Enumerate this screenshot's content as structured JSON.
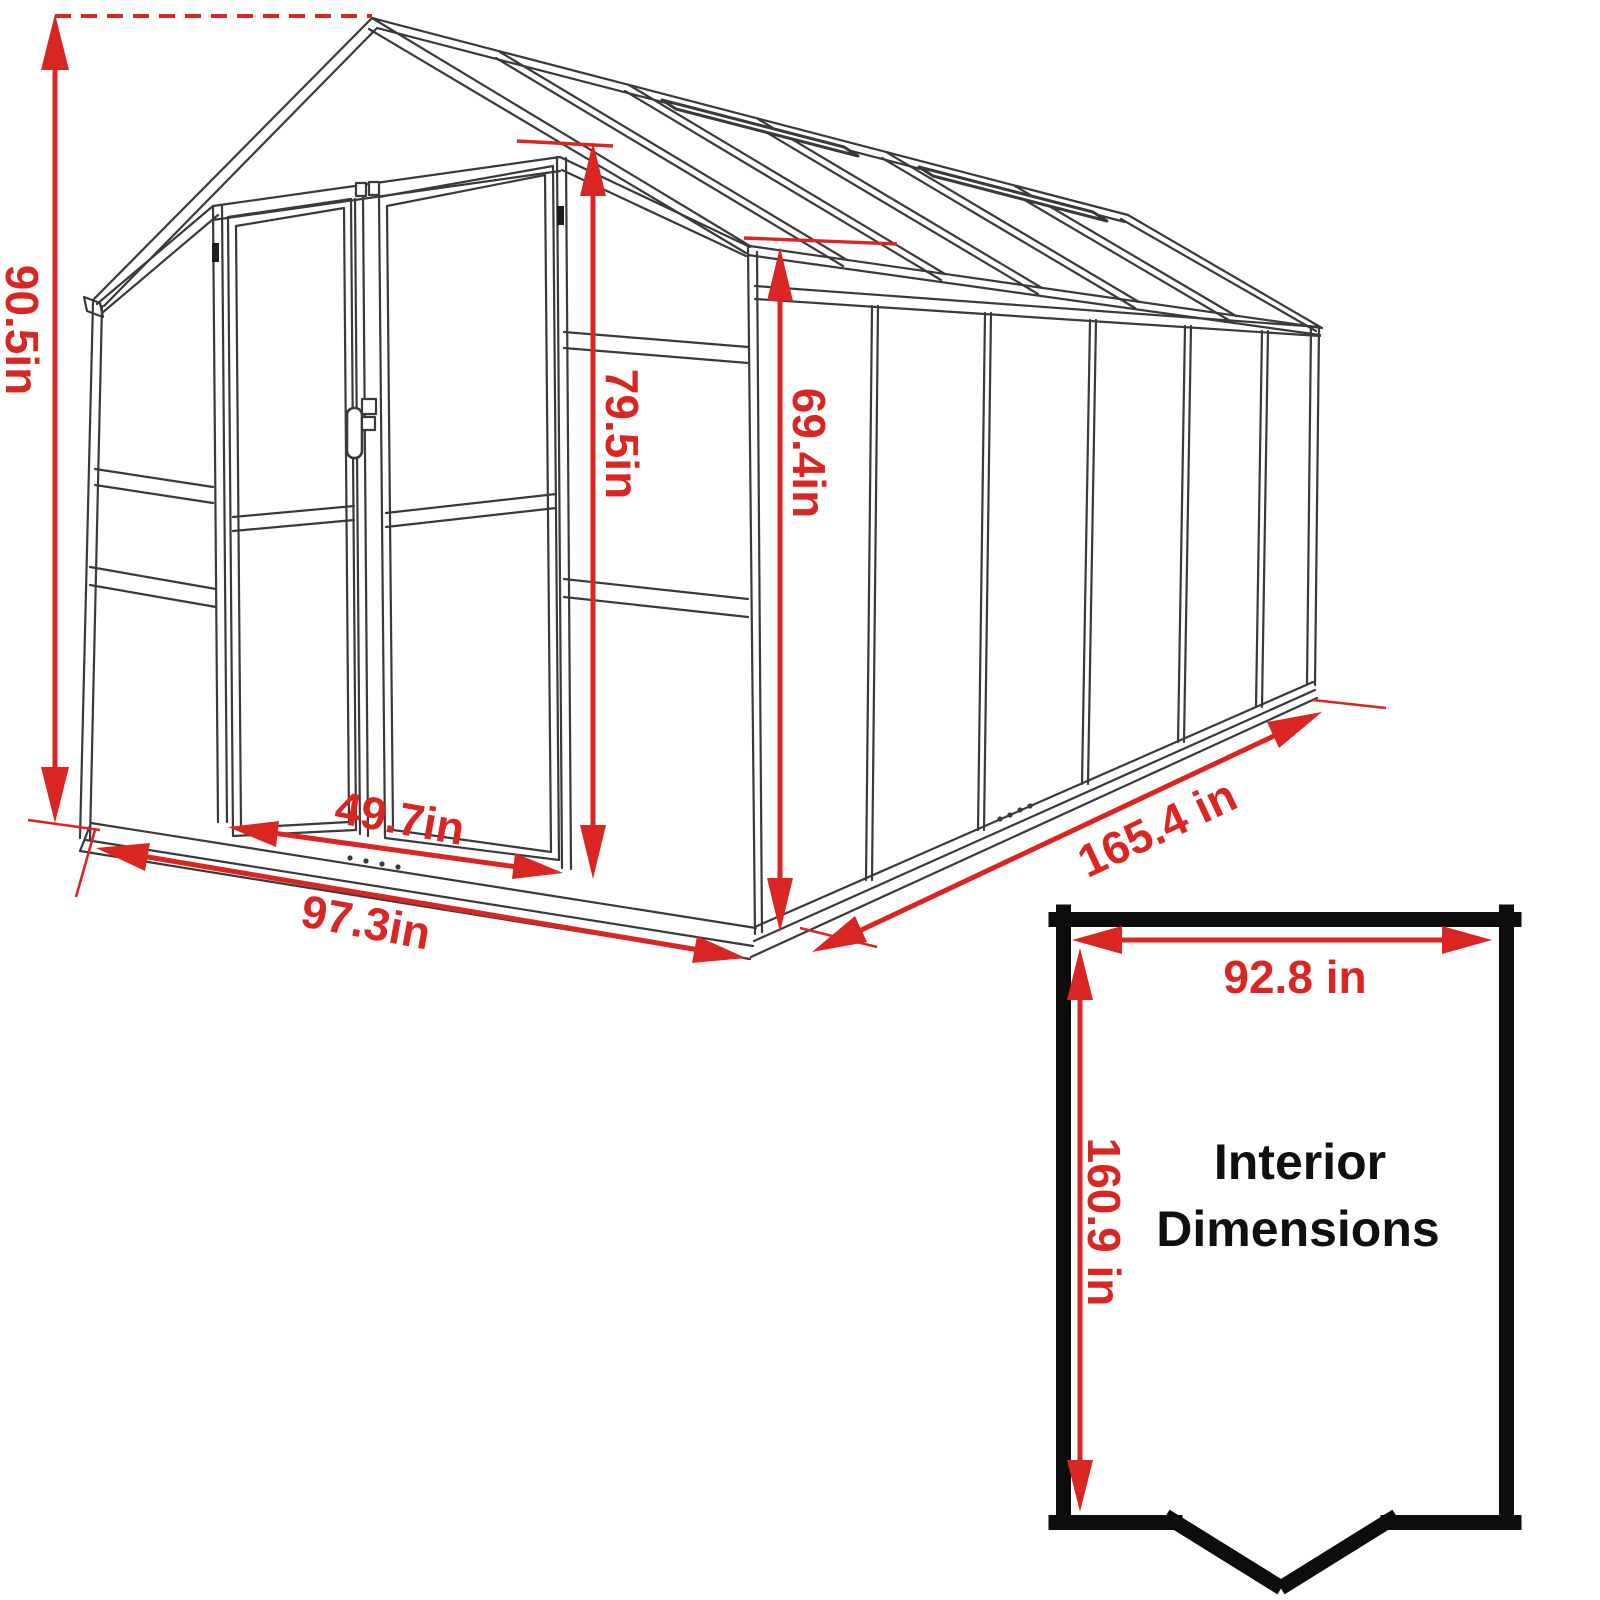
{
  "diagram": {
    "type": "greenhouse-dimension-drawing",
    "labels": {
      "overall_height": "90.5in",
      "door_height": "79.5in",
      "side_wall_height": "69.4in",
      "door_width": "49.7in",
      "front_width": "97.3in",
      "side_length": "165.4 in"
    },
    "interior": {
      "width": "92.8 in",
      "depth": "160.9 in",
      "title_line1": "Interior",
      "title_line2": "Dimensions"
    },
    "colors": {
      "dimension_red": "#d92622",
      "drawing_line": "#3a3a3a",
      "interior_box_black": "#0d0d0d",
      "background": "#ffffff"
    }
  }
}
